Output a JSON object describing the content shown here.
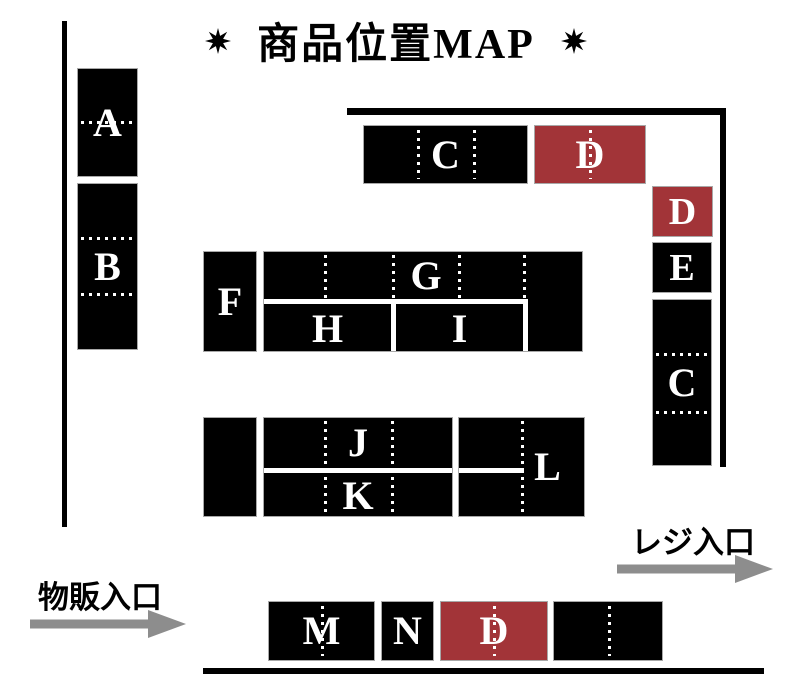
{
  "title": {
    "text": "商品位置MAP"
  },
  "icons": {
    "title_star_left": "eight-point-star",
    "title_star_right": "eight-point-star",
    "merchandise_arrow": "right-arrow",
    "register_arrow": "right-arrow"
  },
  "shelves": {
    "a": "A",
    "b": "B",
    "c_top": "C",
    "d_top": "D",
    "d_right": "D",
    "e": "E",
    "c_right": "C",
    "f": "F",
    "g": "G",
    "h": "H",
    "i": "I",
    "j": "J",
    "k": "K",
    "l": "L",
    "m": "M",
    "n": "N",
    "d_bottom": "D"
  },
  "entrances": {
    "merchandise": "物販入口",
    "register": "レジ入口"
  },
  "colors": {
    "shelf": "#000000",
    "highlight": "#a23438",
    "arrow": "#8d8d8d"
  }
}
